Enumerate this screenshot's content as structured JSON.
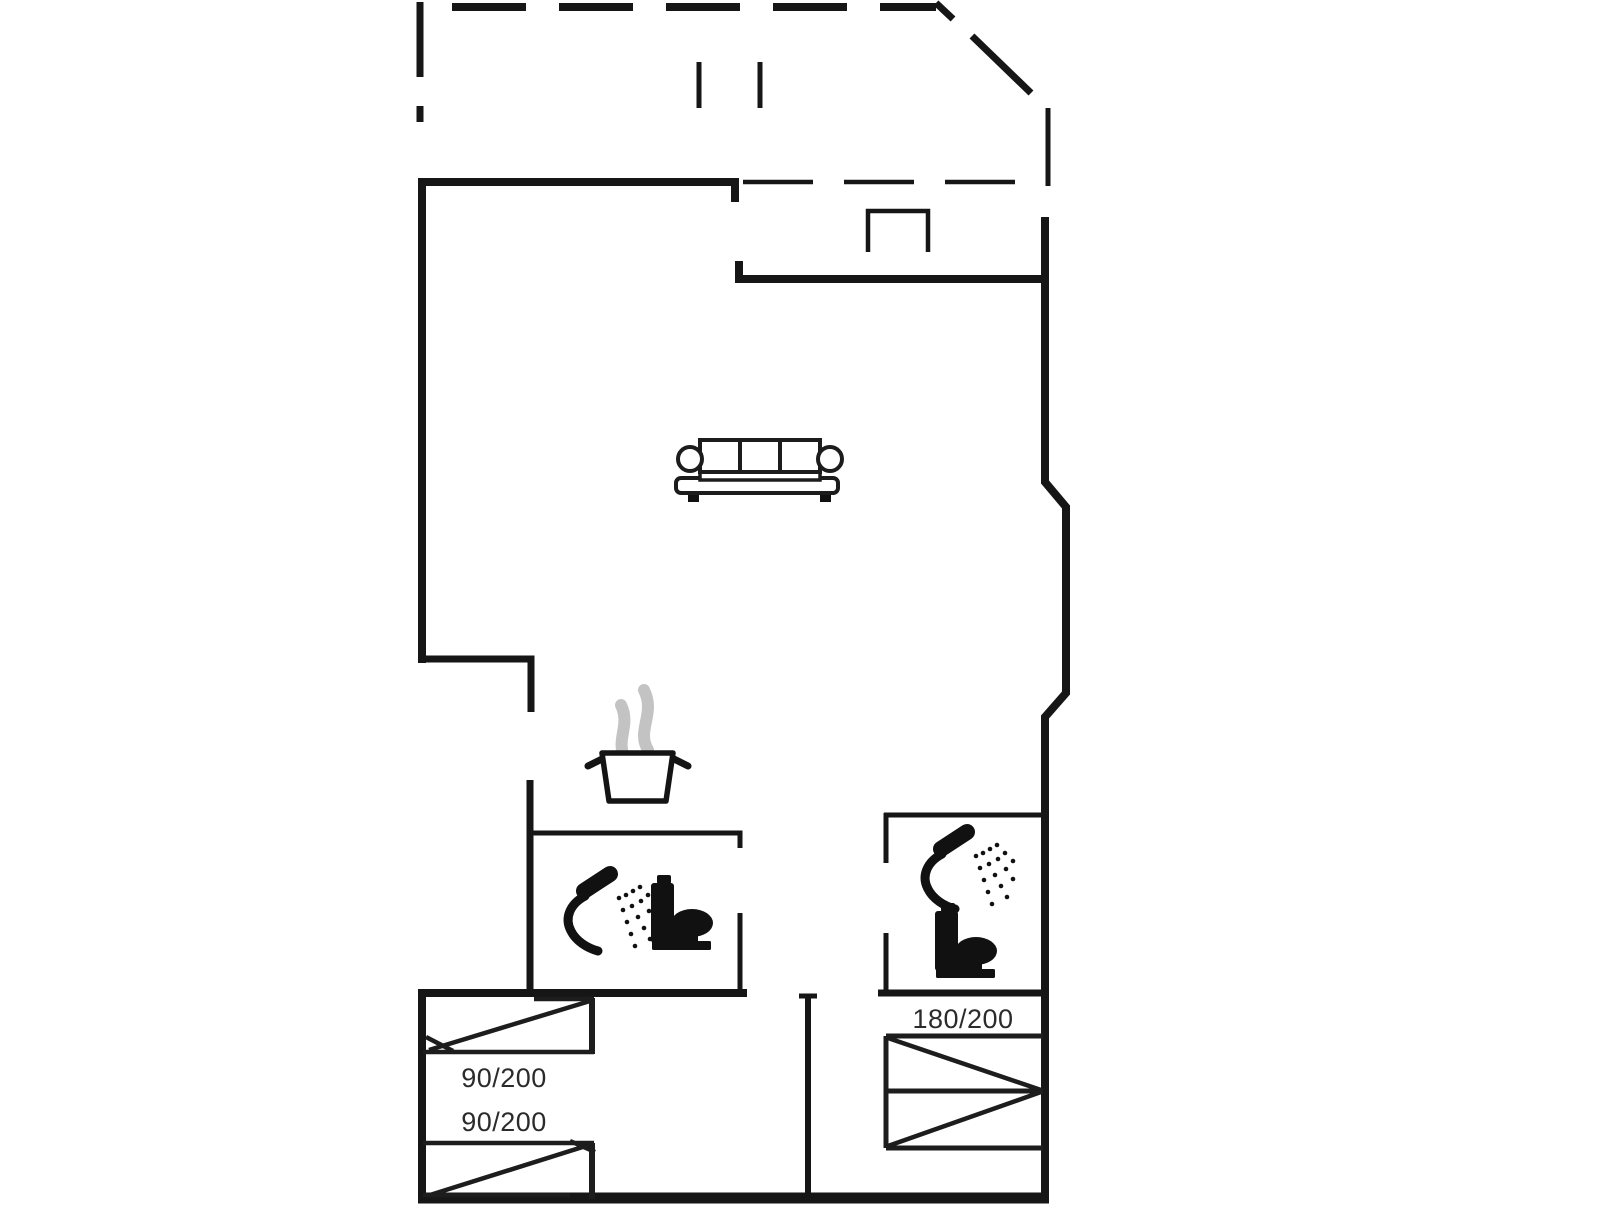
{
  "floorplan": {
    "type": "vacation-house-floor-plan",
    "bed_labels": [
      "90/200",
      "90/200",
      "180/200"
    ],
    "icons": [
      "sofa-icon",
      "cooking-pot-icon",
      "steam-icon",
      "shower-icon",
      "toilet-icon",
      "single-bed-icon",
      "double-bed-icon",
      "terrace-dashed-outline",
      "fireplace-niche"
    ],
    "colors": {
      "background": "#ffffff",
      "walls": "#161616",
      "icon_black": "#111111",
      "steam_gray": "#c3c3c3",
      "label_text": "#2b2b2b"
    }
  }
}
